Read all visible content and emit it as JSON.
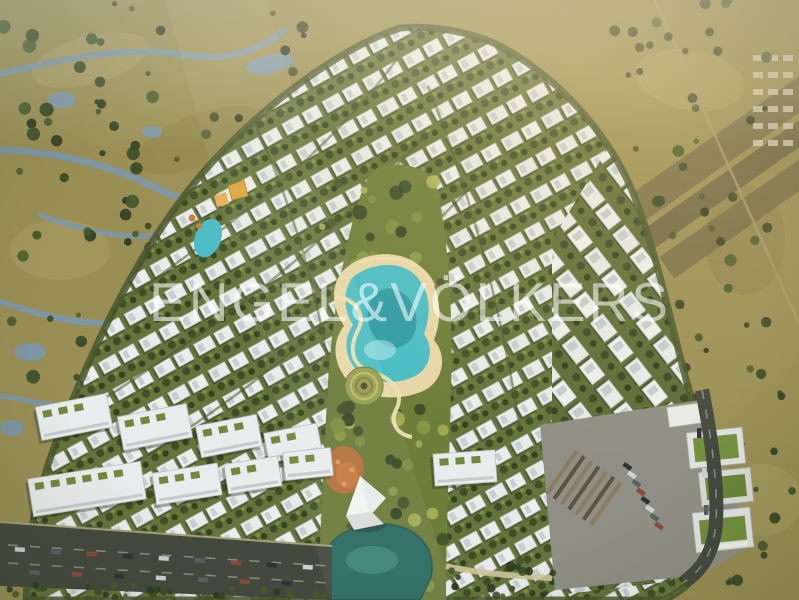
{
  "watermark": {
    "text": "ENGEL&VÖLKERS"
  },
  "palette": {
    "desert": "#998f55",
    "wetland_water": "#7b97ac",
    "development_green": "#5f6e37",
    "park_green": "#6d7d3a",
    "villa_white": "#e8ebea",
    "tree_dark": "#3a4c27",
    "lagoon": "#49bdc6",
    "lagoon_deep": "#19818f",
    "sand_path": "#e6d7a8",
    "lake": "#2a6b63",
    "road": "#44493f",
    "plaza": "#908f85",
    "roof_green": "#73903f",
    "accent_orange": "#c1703f",
    "gold_canopy": "#d8a43c",
    "watermark": "#ffffff"
  }
}
